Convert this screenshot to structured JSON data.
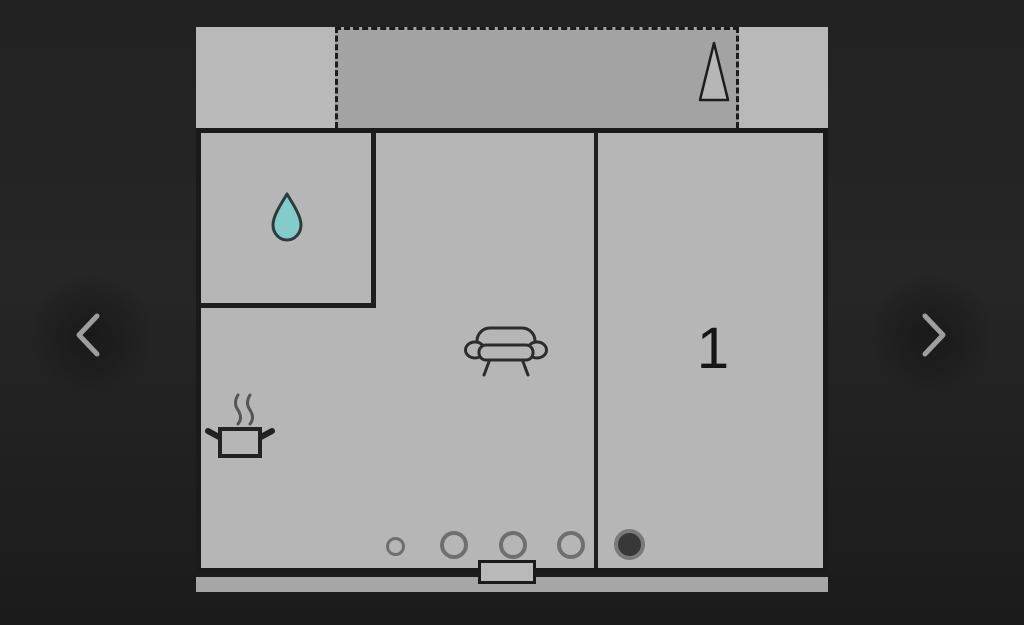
{
  "app": {
    "type": "image-carousel",
    "current_view": "floor-plan"
  },
  "carousel": {
    "prev_icon": "chevron-left",
    "next_icon": "chevron-right"
  },
  "floorplan": {
    "room_label": "1",
    "areas": {
      "balcony": "dashed outlined terrace strip along top with cone/tree marker",
      "bathroom": "top-left room marked with water-drop icon",
      "living_area": "center room with sofa icon",
      "kitchen": "lower-left area with steaming-pot icon and burner ring markers",
      "room_1": "right room labeled 1 with filled circle marker",
      "entry": "door threshold rectangle at bottom center"
    },
    "icons": {
      "balcony_marker": "cone-outline-icon",
      "bathroom_marker": "water-drop-icon",
      "living_marker": "sofa-icon",
      "kitchen_marker": "steaming-pot-icon",
      "ring_markers_count": 4,
      "filled_marker_count": 1
    },
    "colors": {
      "page_background": "#212121",
      "plan_fill": "#b6b6b6",
      "balcony_fill": "#a3a3a3",
      "baseboard_fill": "#a6a6a6",
      "wall_line": "#1a1a1a",
      "water_drop_fill": "#84cbcb",
      "chevron": "#9e9e9e",
      "burner_ring": "#6f6f6f",
      "filled_marker": "#383838"
    }
  }
}
